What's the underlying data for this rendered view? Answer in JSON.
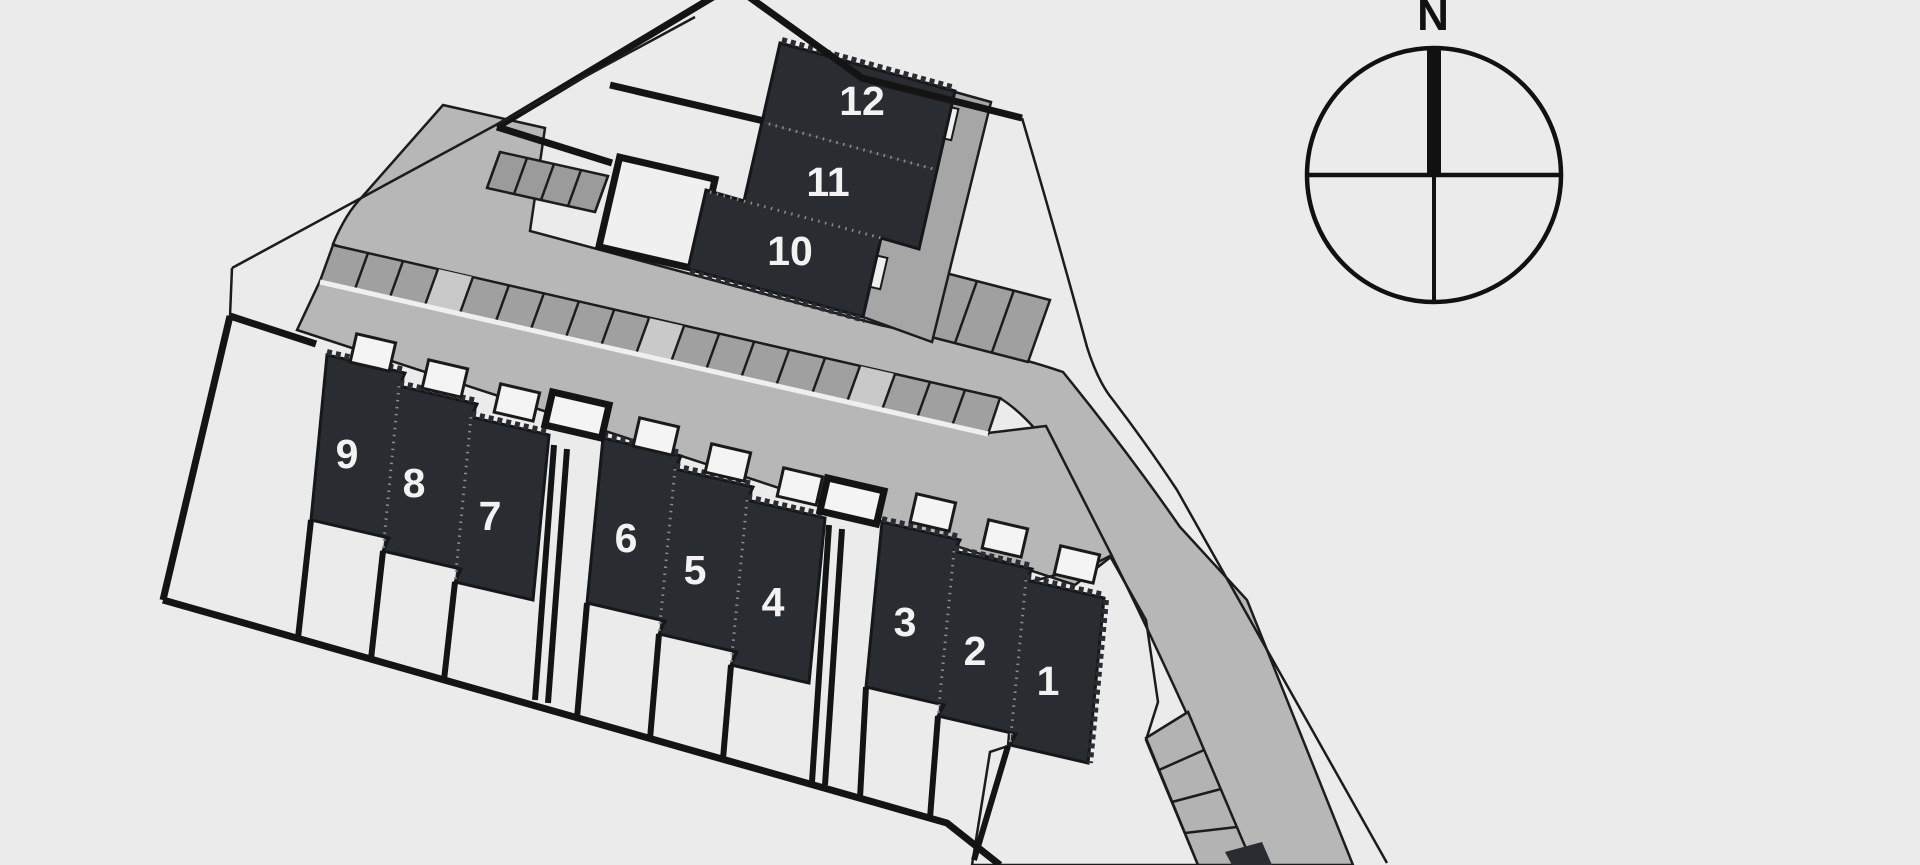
{
  "plan": {
    "type": "residential-site-plan",
    "units": [
      {
        "id": 1,
        "label": "1"
      },
      {
        "id": 2,
        "label": "2"
      },
      {
        "id": 3,
        "label": "3"
      },
      {
        "id": 4,
        "label": "4"
      },
      {
        "id": 5,
        "label": "5"
      },
      {
        "id": 6,
        "label": "6"
      },
      {
        "id": 7,
        "label": "7"
      },
      {
        "id": 8,
        "label": "8"
      },
      {
        "id": 9,
        "label": "9"
      },
      {
        "id": 10,
        "label": "10"
      },
      {
        "id": 11,
        "label": "11"
      },
      {
        "id": 12,
        "label": "12"
      }
    ]
  },
  "compass": {
    "label": "N"
  },
  "colors": {
    "background": "#ebebeb",
    "road": "#b7b7b7",
    "pavement": "#b7b7b7",
    "parking_cell": "#a0a0a0",
    "parking_cell_empty": "#c9c9c9",
    "stub_cell": "#9b9b9b",
    "terrace": "#a6a6a6",
    "building": "#292c30",
    "unit_number": "#f2f2f2",
    "green_space": "#3ea636",
    "plot_line": "#141414",
    "outline": "#1c1c1c",
    "shed_fill": "#f4f4f4",
    "garden_fill": "#f0f0f0"
  }
}
